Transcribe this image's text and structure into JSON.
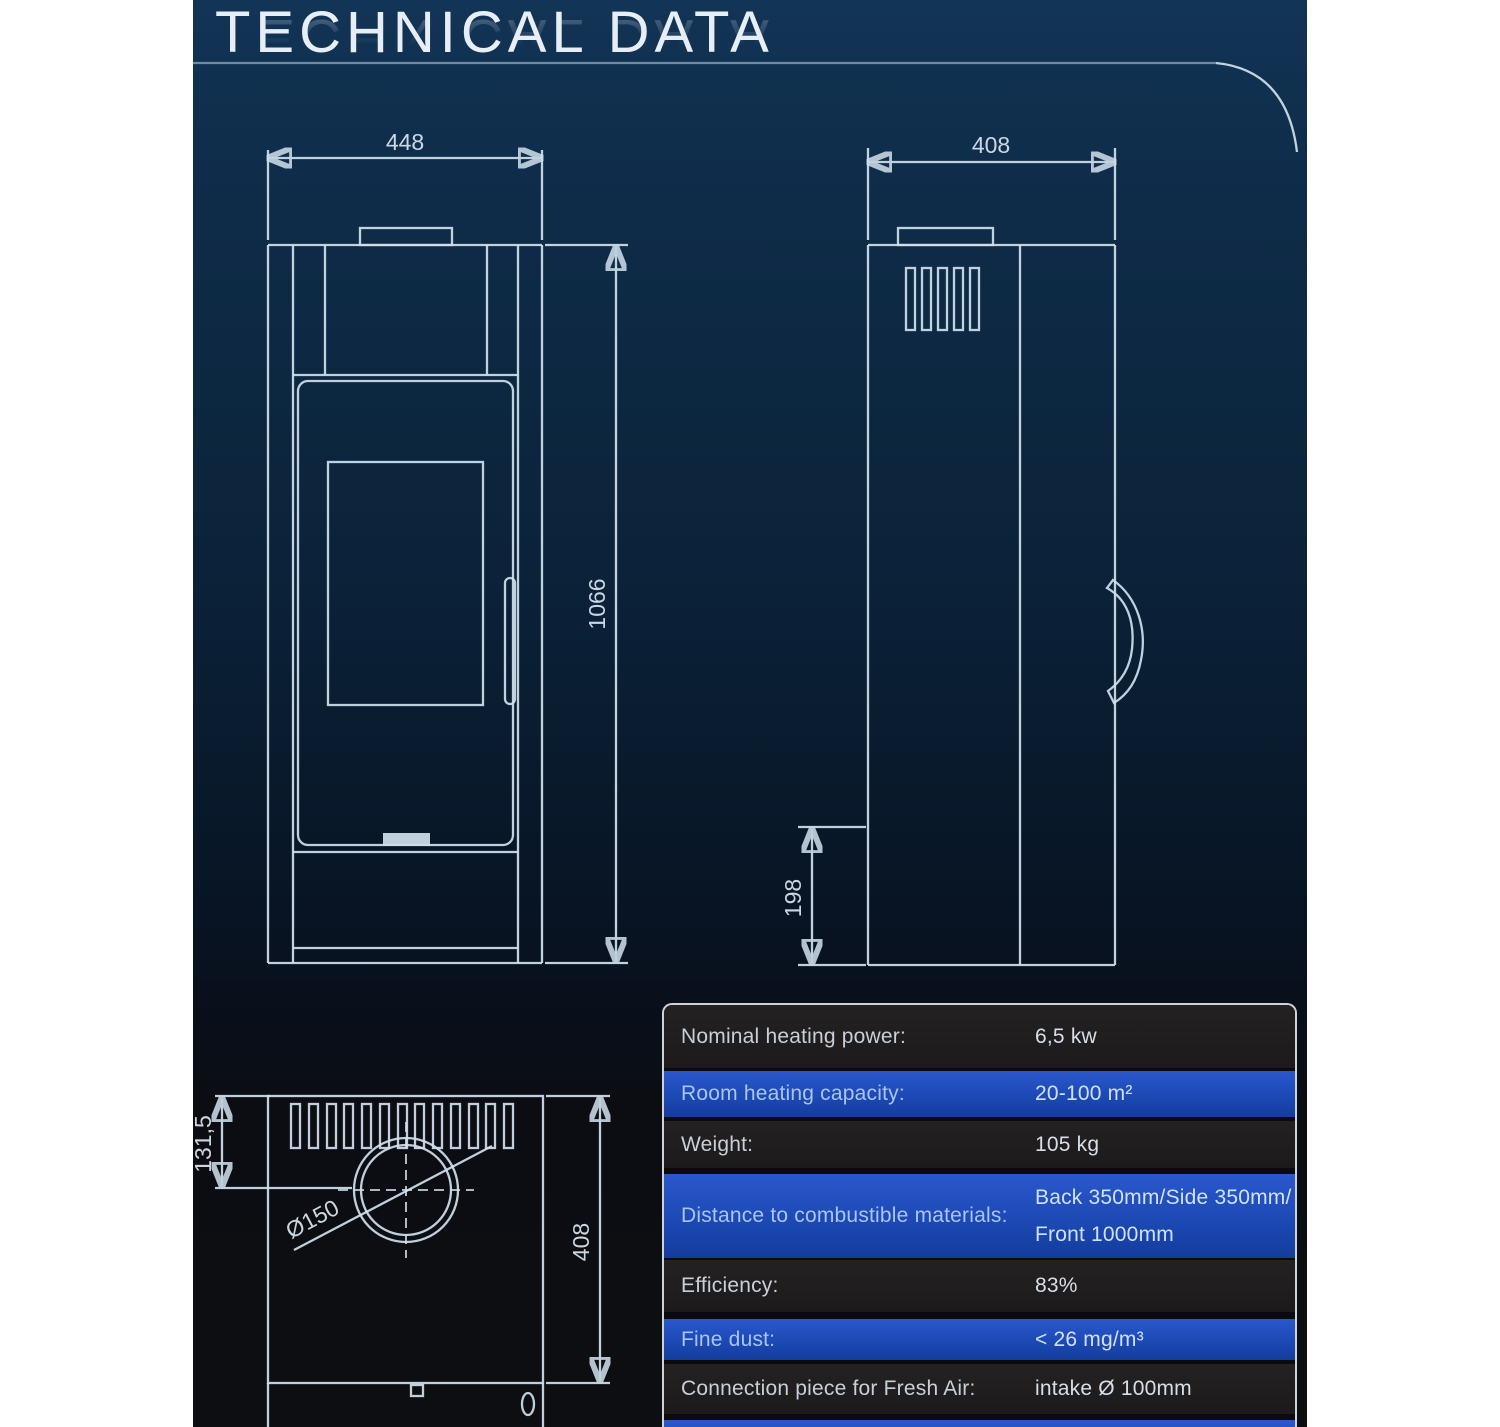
{
  "title": {
    "text": "TECHNICAL DATA"
  },
  "colors": {
    "panel_navy_top": "#123456",
    "panel_near_black_bottom": "#0c0e12",
    "drawing_line": "#cfdfeb",
    "table_row_blue": "#1c49b4",
    "table_row_dark": "#1e1c1d",
    "table_border": "#f2f6fa",
    "page_margin": "#ffffff"
  },
  "drawings": {
    "front_view": {
      "width_label": "448",
      "height_label": "1066"
    },
    "side_view": {
      "depth_label": "408",
      "base_height_label": "198"
    },
    "top_view": {
      "flue_offset_label": "131,5",
      "flue_diameter_label": "Ø150",
      "depth_label": "408"
    }
  },
  "table": {
    "rows": [
      {
        "label": "Nominal heating power:",
        "value": "6,5 kw"
      },
      {
        "label": "Room heating capacity:",
        "value": "20-100 m²"
      },
      {
        "label": "Weight:",
        "value": "105 kg"
      },
      {
        "label": "Distance to combustible materials:",
        "value": "Back 350mm/Side 350mm/",
        "value2": "Front 1000mm"
      },
      {
        "label": "Efficiency:",
        "value": "83%"
      },
      {
        "label": "Fine dust:",
        "value": "< 26 mg/m³"
      },
      {
        "label": "Connection piece for Fresh Air:",
        "value": "intake Ø 100mm"
      },
      {
        "label": "",
        "value": ""
      }
    ]
  }
}
